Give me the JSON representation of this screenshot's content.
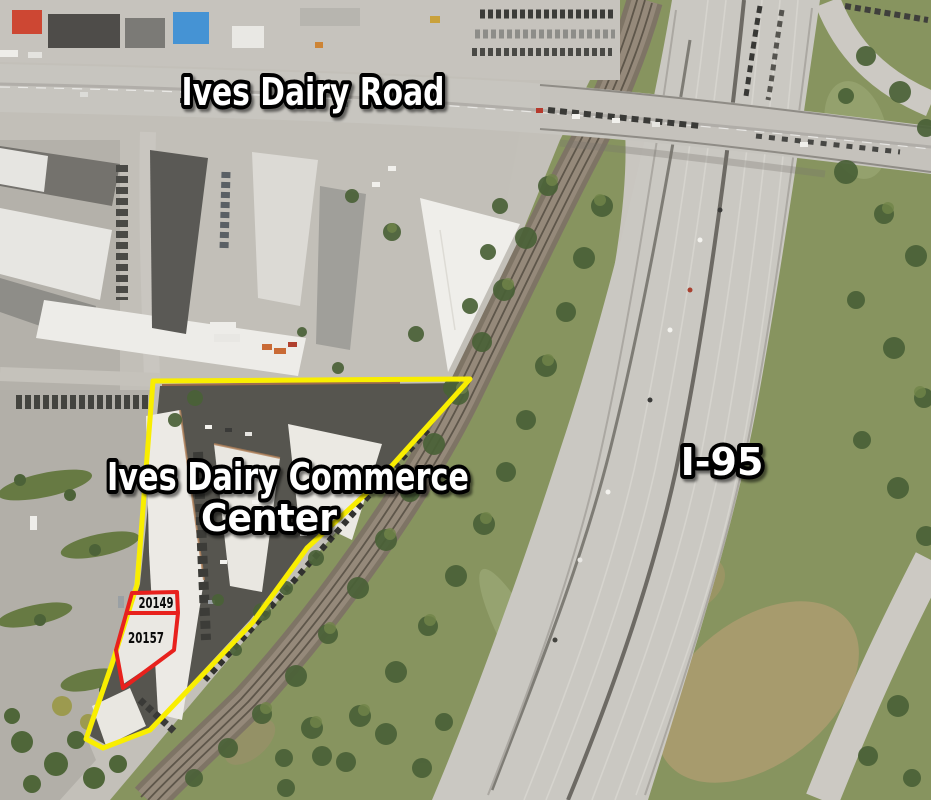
{
  "map": {
    "labels": {
      "road": "Ives Dairy Road",
      "commerce_line1": "Ives Dairy Commerce",
      "commerce_line2": "Center",
      "highway": "I-95"
    },
    "parcels": [
      {
        "id": "20149"
      },
      {
        "id": "20157"
      }
    ],
    "colors": {
      "site_boundary": "#F9EE00",
      "parcel_outline": "#E8211D",
      "label_fill": "#FFFFFF",
      "label_outline": "#000000"
    }
  }
}
